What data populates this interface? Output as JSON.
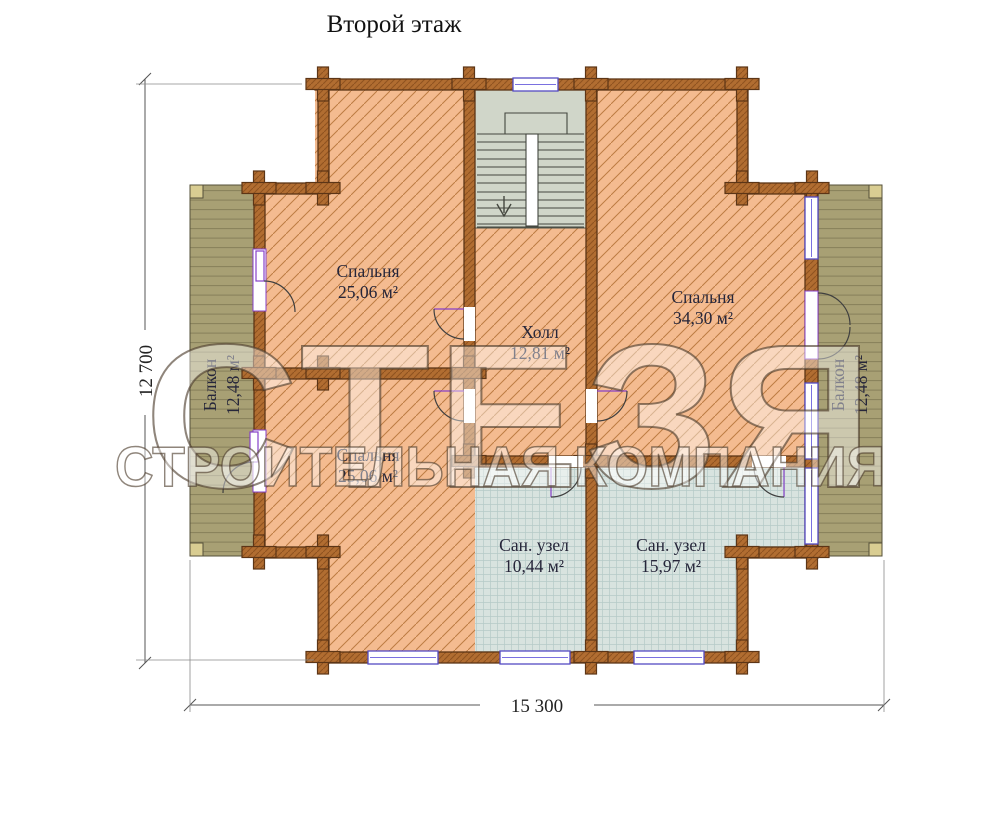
{
  "title": "Второй этаж",
  "watermark": {
    "brand": "СТЕЗЯ",
    "tagline": "СТРОИТЕЛЬНАЯ КОМПАНИЯ"
  },
  "rooms": [
    {
      "id": "bedroom-top-left",
      "name": "Спальня",
      "area": "25,06 м²"
    },
    {
      "id": "bedroom-right",
      "name": "Спальня",
      "area": "34,30 м²"
    },
    {
      "id": "hall",
      "name": "Холл",
      "area": "12,81 м²"
    },
    {
      "id": "bedroom-bottom-left",
      "name": "Спальня",
      "area": "25,06 м²"
    },
    {
      "id": "bath-left",
      "name": "Сан. узел",
      "area": "10,44 м²"
    },
    {
      "id": "bath-right",
      "name": "Сан. узел",
      "area": "15,97 м²"
    },
    {
      "id": "balcony-left",
      "name": "Балкон",
      "area": "12,48 м²"
    },
    {
      "id": "balcony-right",
      "name": "Балкон",
      "area": "12,48 м²"
    }
  ],
  "dimensions": {
    "overall_width": "15 300",
    "overall_height": "12 700"
  },
  "colors": {
    "room_fill": "#f4bb90",
    "room_hatch": "#bd7c43",
    "wall_fill": "#b16d31",
    "wall_outline": "#5c3516",
    "balcony_fill": "#a8a074",
    "tile_fill": "#d8e3df",
    "stair_fill": "#d0d6c9",
    "window_frame": "#544bc4",
    "door_leaf": "#8640c8"
  }
}
